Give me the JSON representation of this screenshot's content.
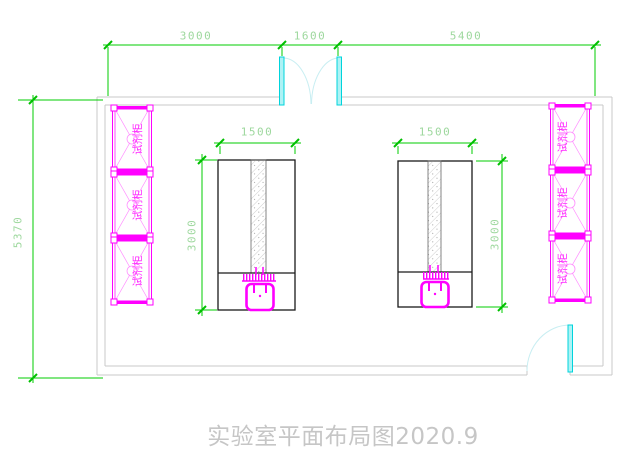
{
  "drawing": {
    "title": "实验室平面布局图2020.9",
    "cabinet_label": "试剂柜",
    "dims": {
      "top_left": "3000",
      "top_middle": "1600",
      "top_right": "5400",
      "room_height": "5370",
      "bench_left_width": "1500",
      "bench_left_depth": "3000",
      "bench_right_width": "1500",
      "bench_right_depth": "3000"
    },
    "colors": {
      "dimension_line": "#00cc00",
      "dimension_tick": "#00c000",
      "dimension_text": "#9ed89e",
      "cabinet": "#ff00ff",
      "cabinet_text": "#ff2bff",
      "door_leaf": "#00d4dc",
      "door_arc": "#c8eef2",
      "wall": "#c9c9c9",
      "bench_outline": "#1a1a1a",
      "hatch": "#c2c2c2",
      "title_text": "#c6c6c6"
    }
  }
}
